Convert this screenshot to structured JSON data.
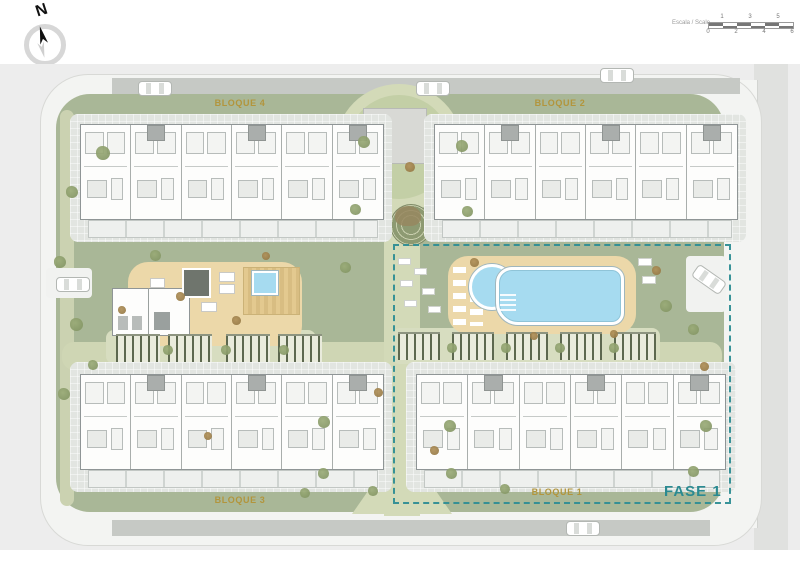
{
  "compass": {
    "label": "N"
  },
  "scale_bar": {
    "label": "Escala / Scale",
    "ticks_top": [
      "1",
      "3",
      "5"
    ],
    "ticks_bottom": [
      "0",
      "2",
      "4",
      "6"
    ]
  },
  "blocks": [
    {
      "id": "bloque-4",
      "label": "BLOQUE 4"
    },
    {
      "id": "bloque-2",
      "label": "BLOQUE 2"
    },
    {
      "id": "bloque-3",
      "label": "BLOQUE 3"
    },
    {
      "id": "bloque-1",
      "label": "BLOQUE 1"
    }
  ],
  "phase": {
    "label": "FASE 1"
  },
  "amenities": {
    "pool": "swimming-pool",
    "kids_pool": "round-kids-pool",
    "gym": "gym-building",
    "spa": "jacuzzi",
    "plaza": "central-plaza",
    "amphitheater": "circular-garden"
  },
  "colors": {
    "block_label": "#b2953c",
    "phase_accent": "#2f8e95",
    "grass": "#a9b797",
    "path": "#d3dab8",
    "pool_water": "#a6dbf0",
    "deck_sand": "#ecd8a9",
    "road": "#c6c9c5"
  }
}
